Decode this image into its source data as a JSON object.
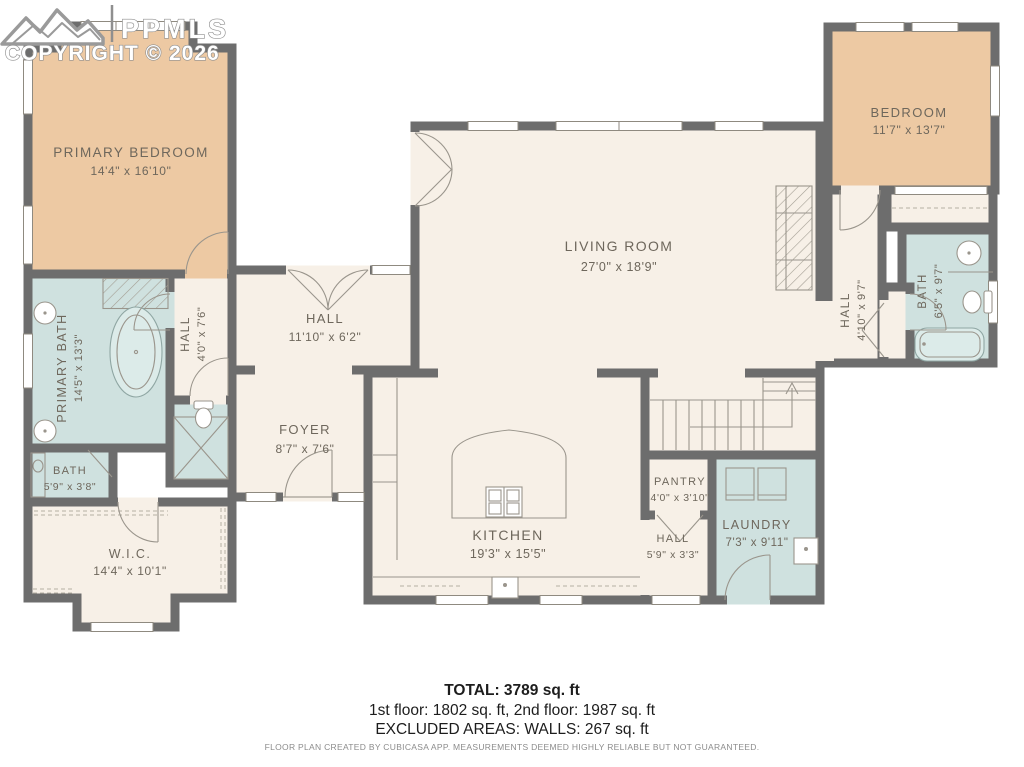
{
  "watermark": {
    "brand": "PPMLS",
    "copyright": "COPYRIGHT © 2026"
  },
  "rooms": [
    {
      "id": "primary-bedroom",
      "name": "PRIMARY BEDROOM",
      "dims": "14'4\" x 16'10\""
    },
    {
      "id": "primary-bath",
      "name": "PRIMARY BATH",
      "dims": "14'5\" x 13'3\""
    },
    {
      "id": "bath-left",
      "name": "BATH",
      "dims": "5'9\" x 3'8\""
    },
    {
      "id": "walk-in-closet",
      "name": "W.I.C.",
      "dims": "14'4\" x 10'1\""
    },
    {
      "id": "hall-left",
      "name": "HALL",
      "dims": "4'0\" x 7'6\""
    },
    {
      "id": "hall-center",
      "name": "HALL",
      "dims": "11'10\" x 6'2\""
    },
    {
      "id": "foyer",
      "name": "FOYER",
      "dims": "8'7\" x 7'6\""
    },
    {
      "id": "living-room",
      "name": "LIVING ROOM",
      "dims": "27'0\" x 18'9\""
    },
    {
      "id": "kitchen",
      "name": "KITCHEN",
      "dims": "19'3\" x 15'5\""
    },
    {
      "id": "pantry",
      "name": "PANTRY",
      "dims": "4'0\" x 3'10\""
    },
    {
      "id": "hall-lower",
      "name": "HALL",
      "dims": "5'9\" x 3'3\""
    },
    {
      "id": "laundry",
      "name": "LAUNDRY",
      "dims": "7'3\" x 9'11\""
    },
    {
      "id": "bedroom",
      "name": "BEDROOM",
      "dims": "11'7\" x 13'7\""
    },
    {
      "id": "hall-right",
      "name": "HALL",
      "dims": "4'10\" x 9'7\""
    },
    {
      "id": "bath-right",
      "name": "BATH",
      "dims": "6'5\" x 9'7\""
    }
  ],
  "summary": {
    "total": "TOTAL: 3789 sq. ft",
    "floors": "1st floor: 1802 sq. ft, 2nd floor: 1987 sq. ft",
    "excluded": "EXCLUDED AREAS: WALLS: 267 sq. ft",
    "disclaimer": "FLOOR PLAN CREATED BY CUBICASA APP. MEASUREMENTS DEEMED HIGHLY RELIABLE BUT NOT GUARANTEED."
  },
  "colors": {
    "wall": "#6d6d6d",
    "floor": "#f7f0e7",
    "bedroom_fill": "#edc9a3",
    "bath_fill": "#cfe1df",
    "label_text": "#6e675c",
    "background": "#ffffff"
  }
}
